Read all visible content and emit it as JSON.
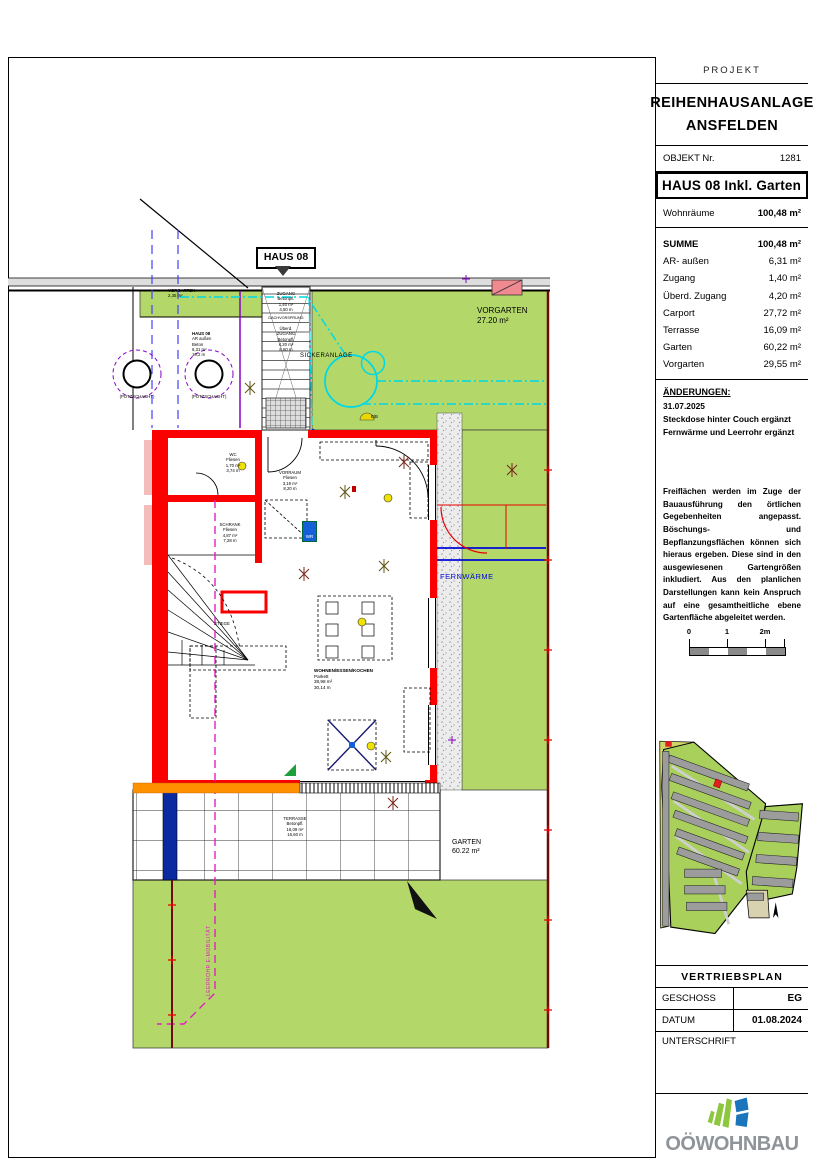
{
  "colors": {
    "grass": "#b3d869",
    "wall_red": "#fa0000",
    "insulation_pink": "#f5bcbc",
    "drain_cyan": "#00d8e4",
    "leerrohr_magenta": "#e020c0",
    "fernwaerme_blue": "#0008d8",
    "boundary_maroon": "#6b0b0b",
    "orange_edge": "#ff9000",
    "shaft_navy": "#0a2aa0",
    "highlight_red": "#e02020",
    "logo_green": "#8dc63f",
    "logo_blue": "#1b75bb",
    "logo_gray": "#8f9499"
  },
  "titleblock": {
    "projekt_label": "PROJEKT",
    "project_name_line1": "REIHENHAUSANLAGE",
    "project_name_line2": "ANSFELDEN",
    "objekt_label": "OBJEKT Nr.",
    "objekt_value": "1281",
    "haus_title": "HAUS 08 Inkl. Garten",
    "wohnraeume_label": "Wohnräume",
    "wohnraeume_value": "100,48 m²",
    "summe": [
      {
        "label": "SUMME",
        "value": "100,48 m²"
      },
      {
        "label": "AR- außen",
        "value": "6,31 m²"
      },
      {
        "label": "Zugang",
        "value": "1,40 m²"
      },
      {
        "label": "Überd. Zugang",
        "value": "4,20 m²"
      },
      {
        "label": "Carport",
        "value": "27,72 m²"
      },
      {
        "label": "Terrasse",
        "value": "16,09 m²"
      },
      {
        "label": "Garten",
        "value": "60,22 m²"
      },
      {
        "label": "Vorgarten",
        "value": "29,55 m²"
      }
    ],
    "aenderungen": {
      "heading": "ÄNDERUNGEN:",
      "date": "31.07.2025",
      "line1": "Steckdose hinter Couch ergänzt",
      "line2": "Fernwärme und Leerrohr ergänzt"
    },
    "disclaimer": "Freiflächen werden im Zuge der Bauausführung den örtlichen Gegebenheiten angepasst. Böschungs- und Bepflanzungsflächen können sich hieraus ergeben. Diese sind in den ausgewiesenen Gartengrößen inkludiert. Aus den planlichen Darstellungen kann kein Anspruch auf eine gesamtheitliche ebene Gartenfläche abgeleitet werden.",
    "scalebar": {
      "l0": "0",
      "l1": "1",
      "l2": "2m"
    },
    "vertriebsplan_label": "VERTRIEBSPLAN",
    "geschoss_label": "GESCHOSS",
    "geschoss_value": "EG",
    "datum_label": "DATUM",
    "datum_value": "01.08.2024",
    "unterschrift_label": "UNTERSCHRIFT",
    "logo_text": "OÖWOHNBAU"
  },
  "plan": {
    "haus_tag": "HAUS 08",
    "vorgarten_small": {
      "l1": "VORGARTEN",
      "l2": "2,35 m²"
    },
    "vorgarten_big": {
      "l1": "VORGARTEN",
      "l2": "27.20 m²"
    },
    "sickeranlage": "SICKERANLAGE",
    "fernwaerme": "FERNWÄRME",
    "garten": {
      "l1": "GARTEN",
      "l2": "60.22 m²"
    },
    "putzschacht_left": "(PUTZSCHACHT)",
    "putzschacht_right": "(PUTZSCHACHT)",
    "leerrohr": "LEERROHR E-MOBILITÄT",
    "bb_mark": "B|B",
    "zugang": {
      "l1": "ZUGANG",
      "l2": "Betonpfl.",
      "l3": "1,40 m²",
      "l4": "4,50 m"
    },
    "dachvorsprung": "DACHVORSPRUNG",
    "ueberd_zugang": {
      "l1": "Überd.",
      "l2": "ZUGANG",
      "l3": "Betonpfl.",
      "l4": "4,20 m²",
      "l5": "8,60 m"
    },
    "ar_aussen": {
      "l1": "HAUS 08",
      "l2": "AR außen",
      "l3": "Beton",
      "l4": "6,31 m²",
      "l5": "10,2 m"
    },
    "wc": {
      "l1": "WC",
      "l2": "Fliesen",
      "l3": "1,70 m²",
      "l4": "3,74 m"
    },
    "vorraum": {
      "l1": "VORRAUM",
      "l2": "Fliesen",
      "l3": "3,19 m²",
      "l4": "8,20 m"
    },
    "schrank": {
      "l1": "SCHRANK",
      "l2": "Fliesen",
      "l3": "4,87 m²",
      "l4": "7,28 m"
    },
    "stiege": "STIEGE",
    "wr": "WR",
    "wohnen": {
      "l1": "WOHNEN/ESSEN/KOCHEN",
      "l2": "Parkett",
      "l3": "38,98 m²",
      "l4": "30,14 m"
    },
    "terrasse": {
      "l1": "TERRASSE",
      "l2": "Betonpfl.",
      "l3": "16,09 m²",
      "l4": "16,60 m"
    }
  }
}
